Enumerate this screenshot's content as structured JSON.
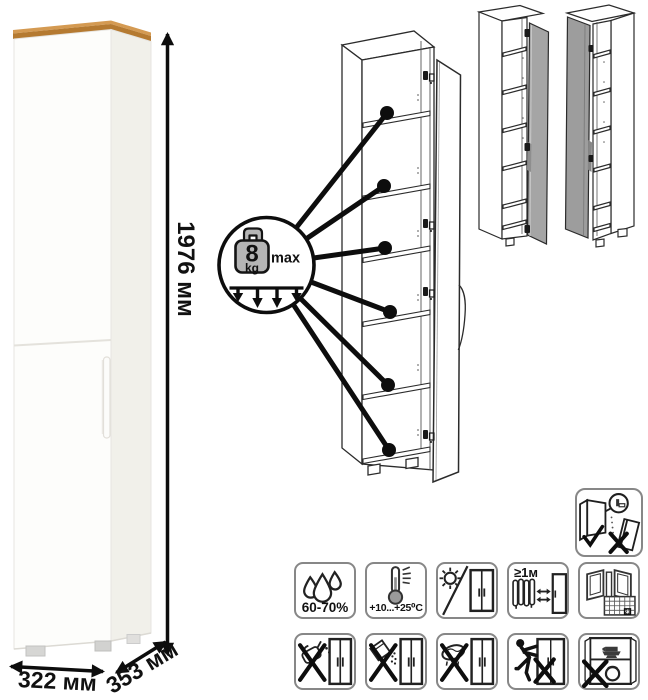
{
  "dimensions": {
    "height": "1976 мм",
    "width": "322 мм",
    "depth": "353 мм"
  },
  "shelf_load_callout": {
    "value": "8",
    "unit": "kg",
    "qualifier": "max"
  },
  "colors": {
    "wood_top": "#c08540",
    "variant_door_gray": "#a5a5a5",
    "line_art": "#0d0d0d"
  },
  "care_icons": {
    "anti_tip_name": "anchor-to-wall-anti-tip-warning",
    "row1": [
      {
        "name": "humidity-range-icon",
        "label": "60-70%"
      },
      {
        "name": "temperature-range-icon",
        "label": "+10...+25⁰C"
      },
      {
        "name": "no-direct-sunlight-icon"
      },
      {
        "name": "min-distance-from-heat-icon",
        "label": "≥1м"
      },
      {
        "name": "ventilate-room-icon",
        "calendar_day": "21"
      }
    ],
    "row2": [
      {
        "name": "no-solvents-icon"
      },
      {
        "name": "no-abrasive-powder-icon"
      },
      {
        "name": "no-wet-cloth-icon"
      },
      {
        "name": "no-dragging-icon"
      },
      {
        "name": "no-overloading-icon"
      }
    ]
  }
}
